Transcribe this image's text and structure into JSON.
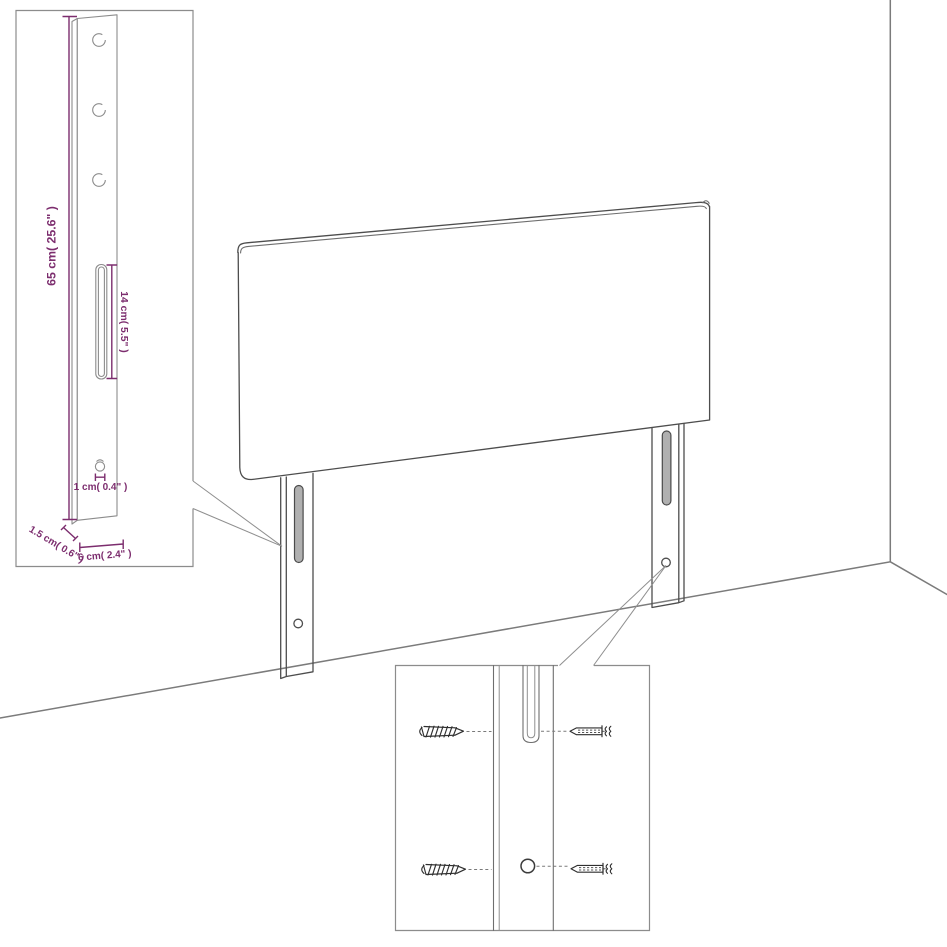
{
  "diagram": {
    "title": "Headboard wall-mount assembly diagram",
    "labels": {
      "bracket_height": "65 cm( 25.6\" )",
      "slot_length": "14 cm( 5.5\" )",
      "hole_diameter": "1 cm( 0.4\" )",
      "bracket_thickness": "1.5 cm( 0.6\" )",
      "bracket_width": "6 cm( 2.4\" )"
    },
    "parts": {
      "screws_shown": 2,
      "wall_plugs_shown": 2,
      "legs_shown": 2,
      "bracket_top_holes": 3
    },
    "colors": {
      "dimension_accent": "#7C2D6E",
      "outline": "#4D4D4D",
      "light_line": "#8C8C8C",
      "slot_fill": "#B0B0B0",
      "background": "#FFFFFF"
    }
  }
}
